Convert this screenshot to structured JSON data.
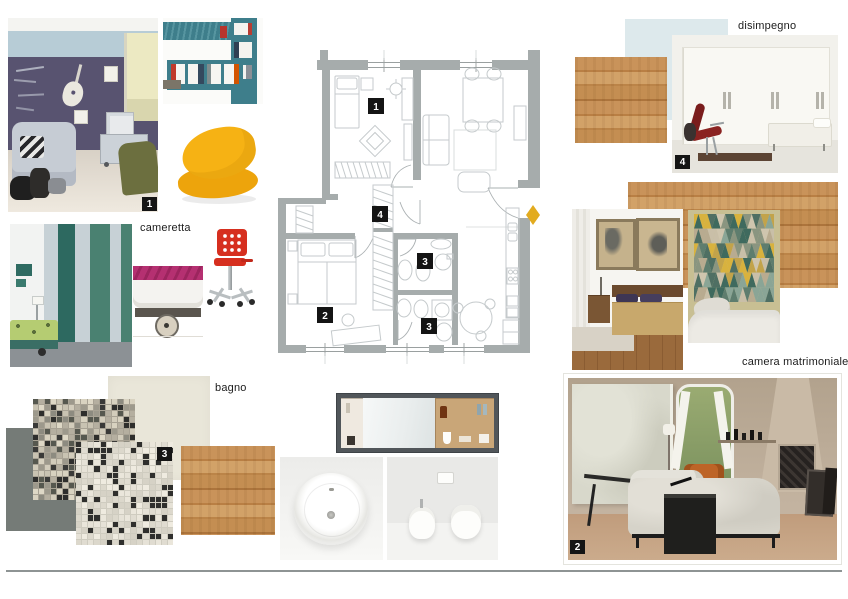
{
  "labels": {
    "cameretta": "cameretta",
    "bagno": "bagno",
    "disimpegno": "disimpegno",
    "camera_matrimoniale": "camera matrimoniale"
  },
  "photo_badges": {
    "cameretta": "1",
    "camera_matrimoniale": "2",
    "bagno": "3",
    "disimpegno": "4"
  },
  "plan": {
    "badges": [
      "1",
      "2",
      "3",
      "3",
      "4"
    ]
  },
  "colors": {
    "wall_gray": "#a6acac",
    "accent_yellow": "#e2ab1f",
    "teal_shelf": "#3e7e8b",
    "teal_dark": "#2d6960",
    "teal_medium": "#4a8171",
    "beanbag_yellow": "#f5b113",
    "chair_red": "#d62f1f",
    "light_blue_swatch": "#dde9ec",
    "cream_tile": "#e9e6d9",
    "gray_tile": "#757b77",
    "divider": "#8e9494"
  },
  "palettes": {
    "triangle": [
      "#8a9580",
      "#5e7d6e",
      "#c9bfa8",
      "#d8b23e",
      "#8aa596",
      "#b8ab90",
      "#4f6f63",
      "#cfc5ae",
      "#3f6a5e",
      "#c2a34a"
    ],
    "mosaic_small": [
      "#d8d2c0",
      "#3a3a38",
      "#b5afa0",
      "#8d8b80",
      "#d2ccbb",
      "#56584f",
      "#c9c3b2",
      "#2e2e2c",
      "#9d998c",
      "#ded8c6"
    ],
    "mosaic_large": [
      "#eae6db",
      "#e0dcd1",
      "#d6d2c6",
      "#2f2f2d",
      "#e6e2d7",
      "#dcd8cc",
      "#2f2f2d",
      "#efebe0"
    ]
  }
}
